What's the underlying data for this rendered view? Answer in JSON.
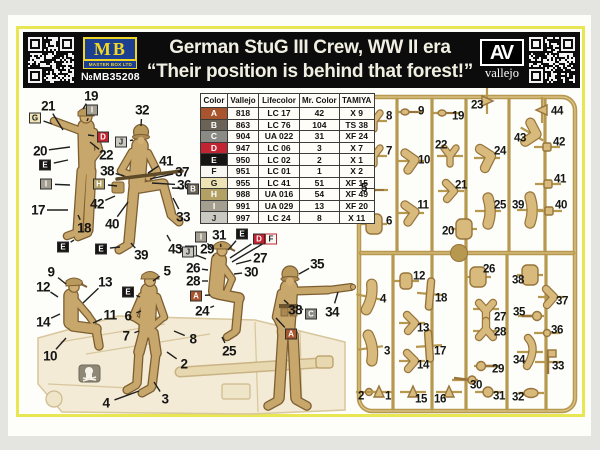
{
  "header": {
    "title": "German StuG III Crew, WW II era",
    "subtitle": "“Their position is behind that forest!”",
    "mb": {
      "abbr": "MB",
      "company": "MASTER BOX LTD",
      "product_no": "№MB35208"
    },
    "vallejo": {
      "abbr": "AV",
      "name": "vallejo"
    }
  },
  "palette": {
    "yellow_border": "#e9e653",
    "header_bg": "#0c0c0c",
    "mb_blue": "#1d3f92",
    "mb_yellow": "#f0d725",
    "figure_tan": "#c8a76c",
    "sprue_gold": "#b6984f"
  },
  "color_table": {
    "headers": [
      "Color",
      "Vallejo",
      "Lifecolor",
      "Mr. Color",
      "TAMIYA"
    ],
    "rows": [
      {
        "letter": "A",
        "swatch": "#a8542c",
        "text": "#ffffff",
        "vallejo": "818",
        "lifecolor": "LC 17",
        "mr_color": "42",
        "tamiya": "X 9"
      },
      {
        "letter": "B",
        "swatch": "#6b6357",
        "text": "#ffffff",
        "vallejo": "863",
        "lifecolor": "LC 76",
        "mr_color": "104",
        "tamiya": "TS 38"
      },
      {
        "letter": "C",
        "swatch": "#8b8b86",
        "text": "#ffffff",
        "vallejo": "904",
        "lifecolor": "UA 022",
        "mr_color": "31",
        "tamiya": "XF 24"
      },
      {
        "letter": "D",
        "swatch": "#c32431",
        "text": "#ffffff",
        "vallejo": "947",
        "lifecolor": "LC 06",
        "mr_color": "3",
        "tamiya": "X 7"
      },
      {
        "letter": "E",
        "swatch": "#171513",
        "text": "#ffffff",
        "vallejo": "950",
        "lifecolor": "LC 02",
        "mr_color": "2",
        "tamiya": "X 1"
      },
      {
        "letter": "F",
        "swatch": "#f8f6f0",
        "text": "#1a1a1a",
        "vallejo": "951",
        "lifecolor": "LC 01",
        "mr_color": "1",
        "tamiya": "X 2"
      },
      {
        "letter": "G",
        "swatch": "#eee3b4",
        "text": "#1a1a1a",
        "vallejo": "955",
        "lifecolor": "LC 41",
        "mr_color": "51",
        "tamiya": "XF 15"
      },
      {
        "letter": "H",
        "swatch": "#b3a065",
        "text": "#ffffff",
        "vallejo": "988",
        "lifecolor": "UA 016",
        "mr_color": "54",
        "tamiya": "XF 49"
      },
      {
        "letter": "I",
        "swatch": "#a39e90",
        "text": "#ffffff",
        "vallejo": "991",
        "lifecolor": "UA 029",
        "mr_color": "13",
        "tamiya": "XF 20"
      },
      {
        "letter": "J",
        "swatch": "#c9c9c2",
        "text": "#2a2a2a",
        "vallejo": "997",
        "lifecolor": "LC 24",
        "mr_color": "8",
        "tamiya": "X 11"
      }
    ]
  },
  "figure_area": {
    "number_labels": [
      {
        "t": "19",
        "x": 91,
        "y": 96,
        "tx": 83,
        "ty": 109
      },
      {
        "t": "21",
        "x": 48,
        "y": 106,
        "tx": 63,
        "ty": 130
      },
      {
        "t": "20",
        "x": 40,
        "y": 151,
        "tx": 70,
        "ty": 147
      },
      {
        "t": "22",
        "x": 106,
        "y": 155,
        "tx": 90,
        "ty": 142
      },
      {
        "t": "17",
        "x": 38,
        "y": 210,
        "tx": 68,
        "ty": 210
      },
      {
        "t": "18",
        "x": 84,
        "y": 228,
        "tx": 78,
        "ty": 215
      },
      {
        "t": "32",
        "x": 142,
        "y": 110,
        "tx": 141,
        "ty": 126
      },
      {
        "t": "41",
        "x": 166,
        "y": 161,
        "tx": 148,
        "ty": 173
      },
      {
        "t": "37",
        "x": 182,
        "y": 172,
        "tx": 150,
        "ty": 179
      },
      {
        "t": "36",
        "x": 184,
        "y": 185,
        "tx": 152,
        "ty": 183
      },
      {
        "t": "38",
        "x": 107,
        "y": 171,
        "tx": 124,
        "ty": 176
      },
      {
        "t": "42",
        "x": 97,
        "y": 204,
        "tx": 115,
        "ty": 196
      },
      {
        "t": "33",
        "x": 183,
        "y": 217,
        "tx": 173,
        "ty": 198
      },
      {
        "t": "40",
        "x": 112,
        "y": 224,
        "tx": 128,
        "ty": 202
      },
      {
        "t": "43",
        "x": 175,
        "y": 249,
        "tx": 167,
        "ty": 235
      },
      {
        "t": "39",
        "x": 141,
        "y": 255,
        "tx": 131,
        "ty": 243
      },
      {
        "t": "9",
        "x": 51,
        "y": 272,
        "tx": 66,
        "ty": 284
      },
      {
        "t": "12",
        "x": 43,
        "y": 287,
        "tx": 58,
        "ty": 297
      },
      {
        "t": "13",
        "x": 105,
        "y": 282,
        "tx": 83,
        "ty": 303
      },
      {
        "t": "14",
        "x": 43,
        "y": 322,
        "tx": 60,
        "ty": 314
      },
      {
        "t": "11",
        "x": 110,
        "y": 315,
        "tx": 93,
        "ty": 323
      },
      {
        "t": "10",
        "x": 50,
        "y": 356,
        "tx": 66,
        "ty": 338
      },
      {
        "t": "5",
        "x": 167,
        "y": 271,
        "tx": 153,
        "ty": 281
      },
      {
        "t": "6",
        "x": 128,
        "y": 316,
        "tx": 141,
        "ty": 311
      },
      {
        "t": "7",
        "x": 126,
        "y": 336,
        "tx": 139,
        "ty": 331
      },
      {
        "t": "8",
        "x": 193,
        "y": 339,
        "tx": 174,
        "ty": 331
      },
      {
        "t": "2",
        "x": 184,
        "y": 364,
        "tx": 167,
        "ty": 352
      },
      {
        "t": "3",
        "x": 165,
        "y": 399,
        "tx": 154,
        "ty": 382
      },
      {
        "t": "4",
        "x": 106,
        "y": 403,
        "tx": 139,
        "ty": 391
      },
      {
        "t": "31",
        "x": 219,
        "y": 235,
        "tx": 221,
        "ty": 247
      },
      {
        "t": "29",
        "x": 207,
        "y": 249,
        "tx": 214,
        "ty": 256
      },
      {
        "t": "27",
        "x": 260,
        "y": 258,
        "tx": 236,
        "ty": 264
      },
      {
        "t": "26",
        "x": 193,
        "y": 268,
        "tx": 208,
        "ty": 270
      },
      {
        "t": "30",
        "x": 251,
        "y": 272,
        "tx": 234,
        "ty": 274
      },
      {
        "t": "28",
        "x": 193,
        "y": 281,
        "tx": 208,
        "ty": 281
      },
      {
        "t": "24",
        "x": 202,
        "y": 311,
        "tx": 214,
        "ty": 306
      },
      {
        "t": "25",
        "x": 229,
        "y": 351,
        "tx": 222,
        "ty": 337
      },
      {
        "t": "35",
        "x": 317,
        "y": 264,
        "tx": 299,
        "ty": 274
      },
      {
        "t": "38",
        "x": 295,
        "y": 310,
        "tx": 284,
        "ty": 300
      },
      {
        "t": "34",
        "x": 332,
        "y": 312,
        "tx": 338,
        "ty": 292
      }
    ],
    "color_badges": [
      {
        "l": "G",
        "x": 35,
        "y": 118,
        "tx": 52,
        "ty": 124
      },
      {
        "l": "I",
        "x": 92,
        "y": 110,
        "tx": 87,
        "ty": 121
      },
      {
        "l": "D",
        "x": 103,
        "y": 137,
        "tx": 88,
        "ty": 135
      },
      {
        "l": "E",
        "x": 45,
        "y": 165,
        "tx": 68,
        "ty": 160
      },
      {
        "l": "I",
        "x": 46,
        "y": 184,
        "tx": 70,
        "ty": 185
      },
      {
        "l": "E",
        "x": 63,
        "y": 247,
        "tx": 74,
        "ty": 240
      },
      {
        "l": "J",
        "x": 121,
        "y": 142,
        "tx": 133,
        "ty": 140
      },
      {
        "l": "H",
        "x": 99,
        "y": 184,
        "tx": 117,
        "ty": 186
      },
      {
        "l": "B",
        "x": 193,
        "y": 189,
        "tx": 172,
        "ty": 188
      },
      {
        "l": "E",
        "x": 101,
        "y": 249,
        "tx": 120,
        "ty": 247
      },
      {
        "l": "J",
        "x": 191,
        "y": 251,
        "tx": 176,
        "ty": 247
      },
      {
        "l": "E",
        "x": 128,
        "y": 292,
        "tx": 140,
        "ty": 297
      },
      {
        "l": "I",
        "x": 201,
        "y": 237,
        "tx": 212,
        "ty": 248
      },
      {
        "l": "E",
        "x": 242,
        "y": 234,
        "tx": 228,
        "ty": 250
      },
      {
        "l": "D",
        "x": 259,
        "y": 239,
        "tx": 230,
        "ty": 258
      },
      {
        "l": "F",
        "x": 271,
        "y": 239,
        "tx": 232,
        "ty": 262
      },
      {
        "l": "J",
        "x": 188,
        "y": 252,
        "tx": 206,
        "ty": 259
      },
      {
        "l": "A",
        "x": 196,
        "y": 296,
        "tx": 210,
        "ty": 295
      },
      {
        "l": "C",
        "x": 311,
        "y": 314,
        "tx": 300,
        "ty": 308
      },
      {
        "l": "A",
        "x": 291,
        "y": 334,
        "tx": 276,
        "ty": 318
      }
    ]
  },
  "sprue": {
    "parts": [
      {
        "n": "8",
        "x": 389,
        "y": 117,
        "bx": 374,
        "by": 121,
        "s": "y",
        "r": 0
      },
      {
        "n": "9",
        "x": 421,
        "y": 112,
        "bx": 409,
        "by": 112,
        "s": "tinystick",
        "r": 0
      },
      {
        "n": "19",
        "x": 458,
        "y": 117,
        "bx": 446,
        "by": 113,
        "s": "tinystick",
        "r": 0
      },
      {
        "n": "23",
        "x": 477,
        "y": 106,
        "bx": 487,
        "by": 101,
        "s": "cone",
        "r": 90
      },
      {
        "n": "44",
        "x": 557,
        "y": 112,
        "bx": 542,
        "by": 110,
        "s": "cone",
        "r": -90
      },
      {
        "n": "7",
        "x": 389,
        "y": 152,
        "bx": 374,
        "by": 156,
        "s": "y",
        "r": 0
      },
      {
        "n": "22",
        "x": 441,
        "y": 146,
        "bx": 450,
        "by": 156,
        "s": "y",
        "r": 0
      },
      {
        "n": "10",
        "x": 424,
        "y": 161,
        "bx": 411,
        "by": 161,
        "s": "bentarm",
        "r": 0
      },
      {
        "n": "24",
        "x": 500,
        "y": 152,
        "bx": 487,
        "by": 158,
        "s": "bentleg",
        "r": 0
      },
      {
        "n": "43",
        "x": 520,
        "y": 139,
        "bx": 532,
        "by": 134,
        "s": "bentleg",
        "r": 30
      },
      {
        "n": "42",
        "x": 559,
        "y": 143,
        "bx": 547,
        "by": 147,
        "s": "sq",
        "r": 0
      },
      {
        "n": "5",
        "x": 364,
        "y": 189,
        "bx": 375,
        "by": 190,
        "s": "tinystick",
        "r": 0
      },
      {
        "n": "21",
        "x": 461,
        "y": 186,
        "bx": 451,
        "by": 191,
        "s": "bent",
        "r": 0
      },
      {
        "n": "41",
        "x": 560,
        "y": 180,
        "bx": 548,
        "by": 184,
        "s": "sq",
        "r": 0
      },
      {
        "n": "6",
        "x": 389,
        "y": 222,
        "bx": 374,
        "by": 224,
        "s": "torso",
        "r": 0
      },
      {
        "n": "11",
        "x": 423,
        "y": 206,
        "bx": 411,
        "by": 213,
        "s": "bentarm",
        "r": 0
      },
      {
        "n": "25",
        "x": 500,
        "y": 206,
        "bx": 488,
        "by": 211,
        "s": "leg",
        "r": 0
      },
      {
        "n": "39",
        "x": 518,
        "y": 206,
        "bx": 530,
        "by": 210,
        "s": "leg",
        "r": 0
      },
      {
        "n": "40",
        "x": 561,
        "y": 206,
        "bx": 549,
        "by": 211,
        "s": "sq",
        "r": 0
      },
      {
        "n": "20",
        "x": 448,
        "y": 232,
        "bx": 464,
        "by": 229,
        "s": "torso",
        "r": 0
      },
      {
        "n": "12",
        "x": 419,
        "y": 277,
        "bx": 406,
        "by": 281,
        "s": "storso",
        "r": 0
      },
      {
        "n": "26",
        "x": 489,
        "y": 270,
        "bx": 478,
        "by": 277,
        "s": "torso",
        "r": 0
      },
      {
        "n": "38",
        "x": 518,
        "y": 281,
        "bx": 530,
        "by": 275,
        "s": "torso",
        "r": 0
      },
      {
        "n": "37",
        "x": 562,
        "y": 302,
        "bx": 551,
        "by": 297,
        "s": "bent",
        "r": 0
      },
      {
        "n": "4",
        "x": 383,
        "y": 300,
        "bx": 369,
        "by": 297,
        "s": "leg",
        "r": 12
      },
      {
        "n": "18",
        "x": 441,
        "y": 299,
        "bx": 430,
        "by": 294,
        "s": "flat",
        "r": 5
      },
      {
        "n": "27",
        "x": 500,
        "y": 318,
        "bx": 486,
        "by": 309,
        "s": "y2",
        "r": 0
      },
      {
        "n": "35",
        "x": 519,
        "y": 313,
        "bx": 531,
        "by": 316,
        "s": "ballstick",
        "r": 0
      },
      {
        "n": "13",
        "x": 423,
        "y": 329,
        "bx": 412,
        "by": 323,
        "s": "bent",
        "r": 0
      },
      {
        "n": "28",
        "x": 500,
        "y": 333,
        "bx": 486,
        "by": 331,
        "s": "y2",
        "r": 180
      },
      {
        "n": "36",
        "x": 557,
        "y": 331,
        "bx": 547,
        "by": 333,
        "s": "tiny",
        "r": 0
      },
      {
        "n": "3",
        "x": 387,
        "y": 352,
        "bx": 370,
        "by": 348,
        "s": "leg",
        "r": -8
      },
      {
        "n": "17",
        "x": 440,
        "y": 352,
        "bx": 429,
        "by": 346,
        "s": "flat",
        "r": -4
      },
      {
        "n": "34",
        "x": 519,
        "y": 361,
        "bx": 530,
        "by": 352,
        "s": "bentflat",
        "r": 0
      },
      {
        "n": "14",
        "x": 423,
        "y": 366,
        "bx": 412,
        "by": 361,
        "s": "bent",
        "r": 0
      },
      {
        "n": "29",
        "x": 498,
        "y": 370,
        "bx": 487,
        "by": 366,
        "s": "ballstick",
        "r": 180
      },
      {
        "n": "33",
        "x": 558,
        "y": 367,
        "bx": 548,
        "by": 362,
        "s": "flag",
        "r": 0
      },
      {
        "n": "30",
        "x": 476,
        "y": 386,
        "bx": 465,
        "by": 380,
        "s": "stickball",
        "r": 0
      },
      {
        "n": "2",
        "x": 361,
        "y": 397,
        "bx": 369,
        "by": 392,
        "s": "tiny",
        "r": 0
      },
      {
        "n": "1",
        "x": 388,
        "y": 397,
        "bx": 379,
        "by": 392,
        "s": "cone",
        "r": 0
      },
      {
        "n": "15",
        "x": 421,
        "y": 400,
        "bx": 413,
        "by": 392,
        "s": "cone",
        "r": 0
      },
      {
        "n": "16",
        "x": 440,
        "y": 400,
        "bx": 449,
        "by": 392,
        "s": "cone",
        "r": 0
      },
      {
        "n": "31",
        "x": 499,
        "y": 397,
        "bx": 488,
        "by": 392,
        "s": "ball",
        "r": 0
      },
      {
        "n": "32",
        "x": 518,
        "y": 398,
        "bx": 531,
        "by": 393,
        "s": "oval",
        "r": 0
      }
    ]
  }
}
